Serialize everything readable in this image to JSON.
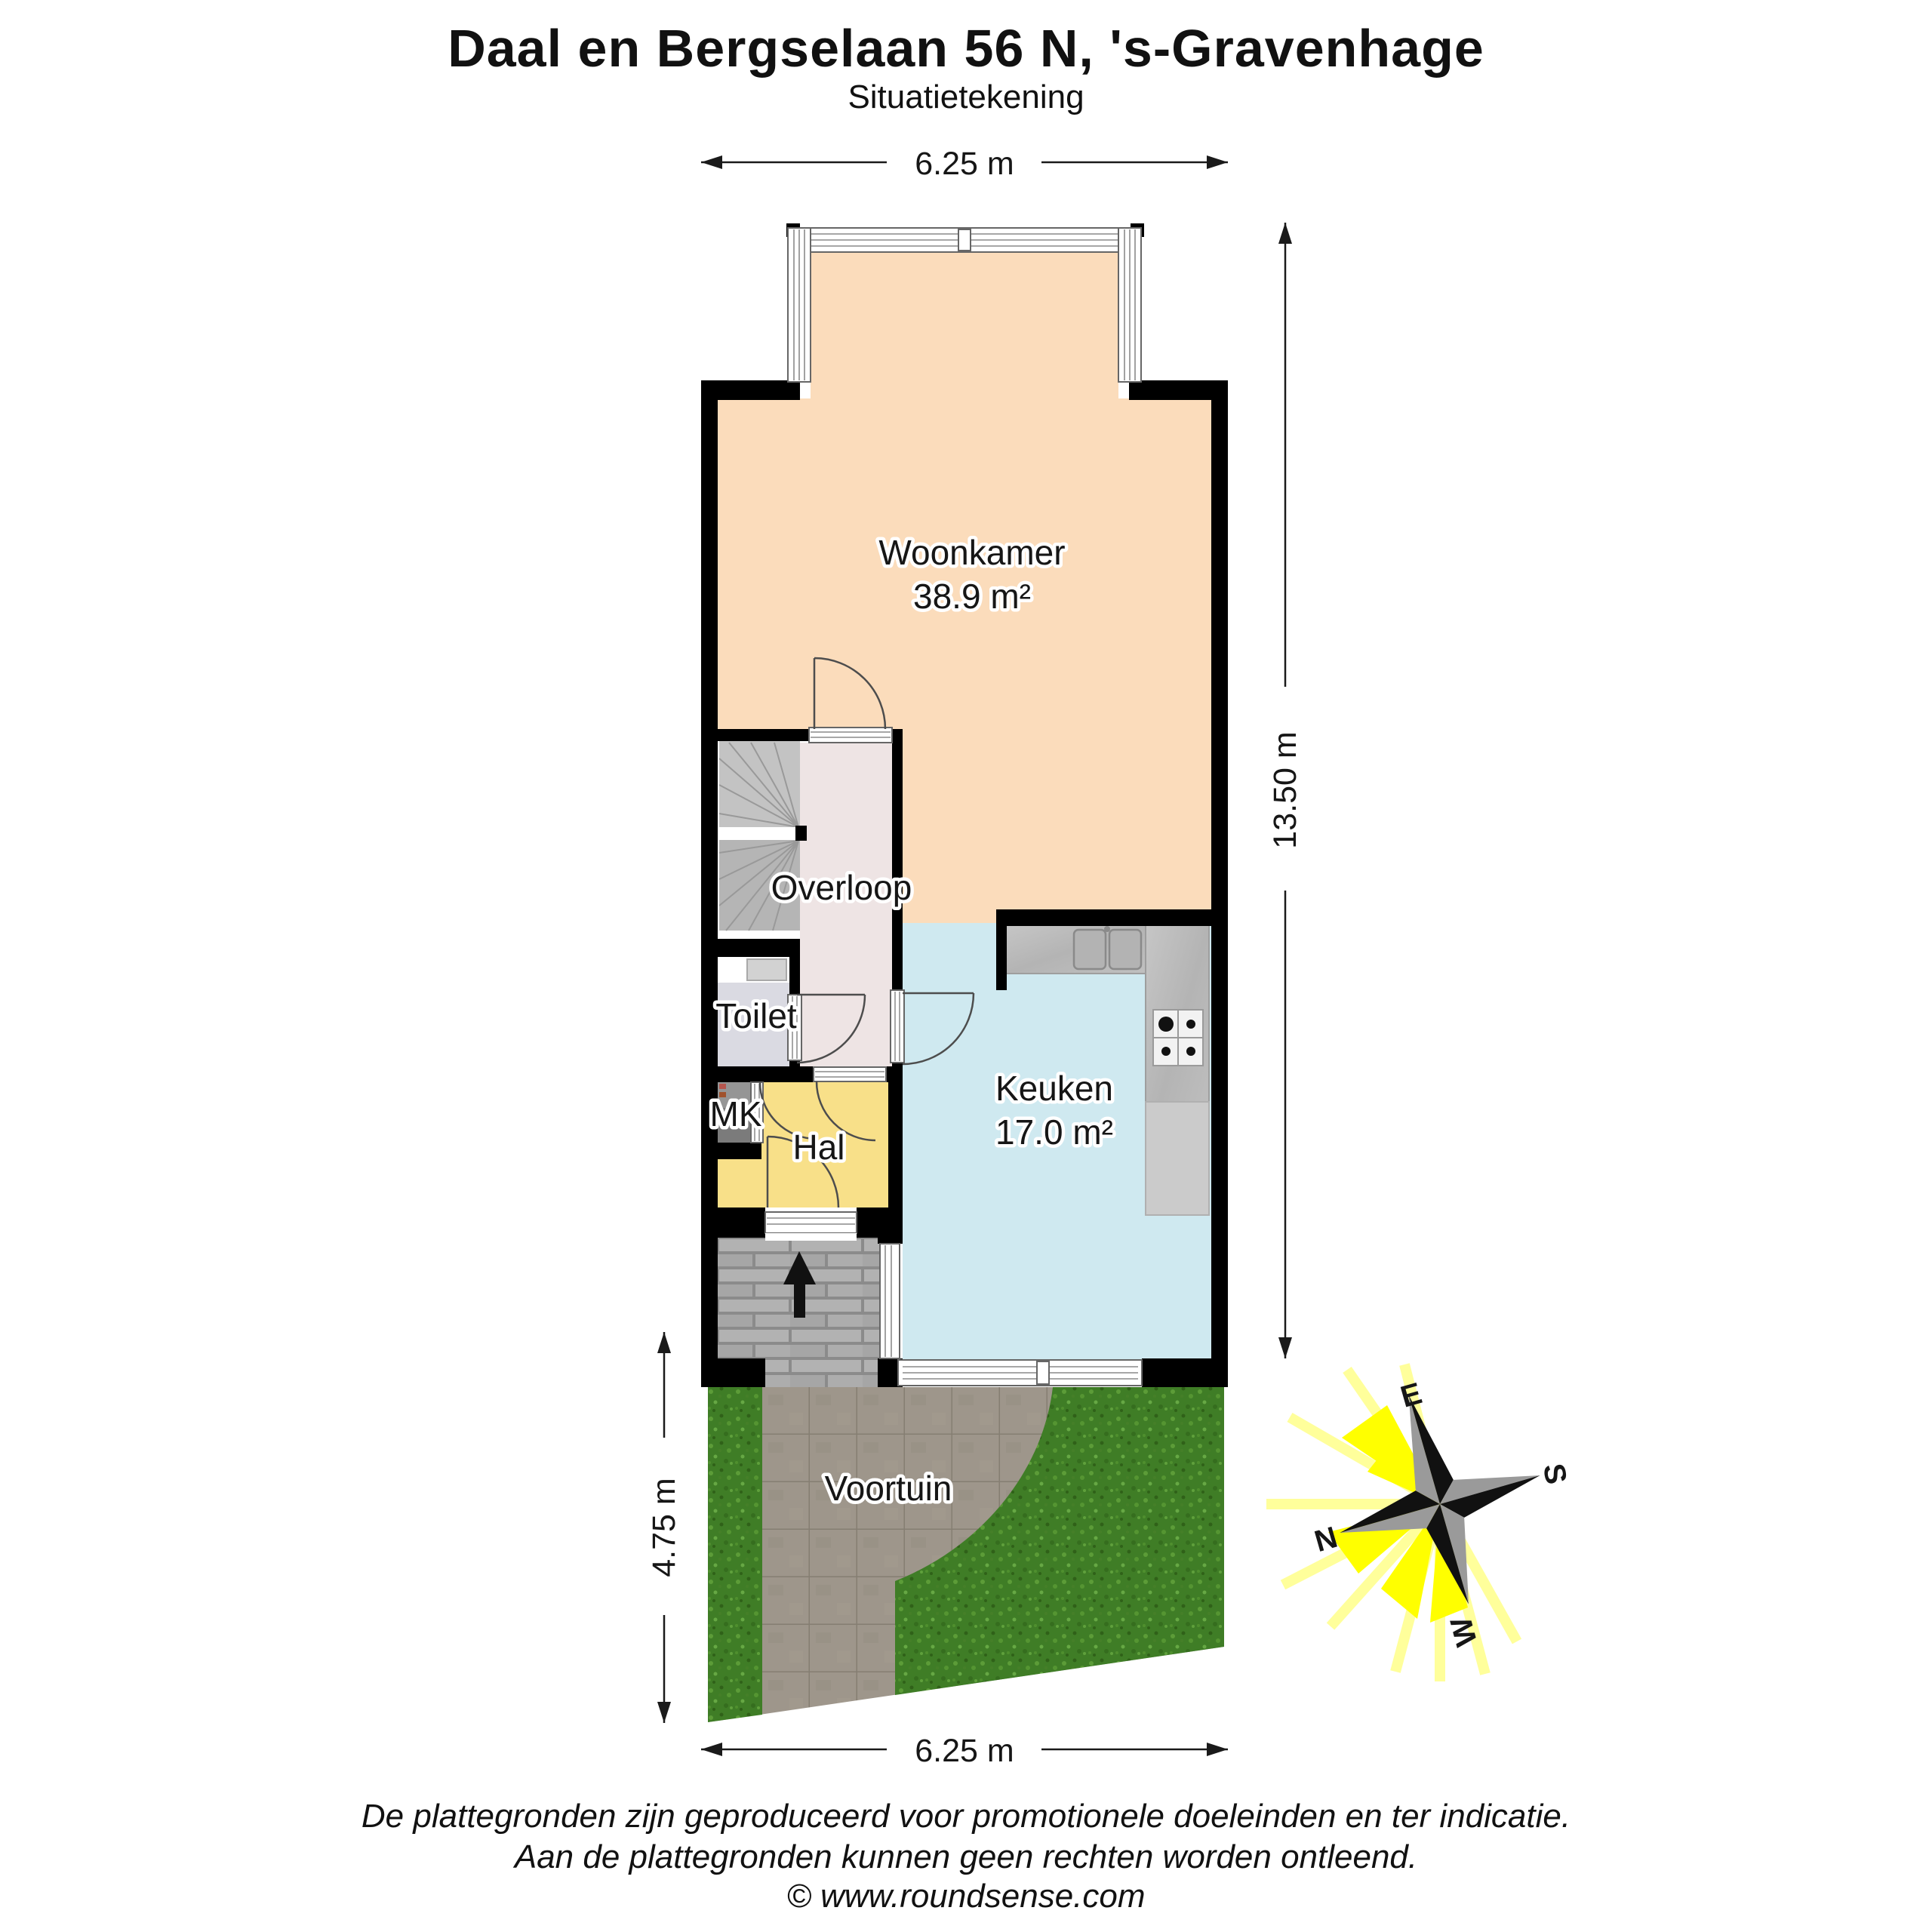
{
  "header": {
    "title": "Daal en Bergselaan 56 N, 's-Gravenhage",
    "subtitle": "Situatietekening"
  },
  "dimensions": {
    "top": "6.25 m",
    "right": "13.50 m",
    "left": "4.75 m",
    "bottom": "6.25 m"
  },
  "rooms": {
    "woonkamer": {
      "label": "Woonkamer",
      "area": "38.9 m²"
    },
    "overloop": {
      "label": "Overloop"
    },
    "toilet": {
      "label": "Toilet"
    },
    "mk": {
      "label": "MK"
    },
    "hal": {
      "label": "Hal"
    },
    "keuken": {
      "label": "Keuken",
      "area": "17.0 m²"
    },
    "voortuin": {
      "label": "Voortuin"
    }
  },
  "compass": {
    "north": "N",
    "east": "E",
    "south": "S",
    "west": "W"
  },
  "footer": {
    "line1": "De plattegronden zijn geproduceerd voor promotionele doeleinden en ter indicatie.",
    "line2": "Aan de plattegronden kunnen geen rechten worden ontleend.",
    "line3": "© www.roundsense.com"
  },
  "colors": {
    "woonkamer_floor": "#fbdcbb",
    "keuken_floor": "#cfe9f0",
    "hal_floor": "#f8e089",
    "overloop_floor": "#eee4e4",
    "toilet_floor": "#dadae2",
    "stairs": "#b5b5b5",
    "wall": "#000000",
    "grass": "#3f7d26",
    "paving": "#9b9489",
    "porch": "#ababab",
    "ray_pale": "#ffff9b",
    "ray_bright": "#ffff00",
    "compass_dark": "#111111",
    "compass_gray": "#9a9a9a"
  }
}
